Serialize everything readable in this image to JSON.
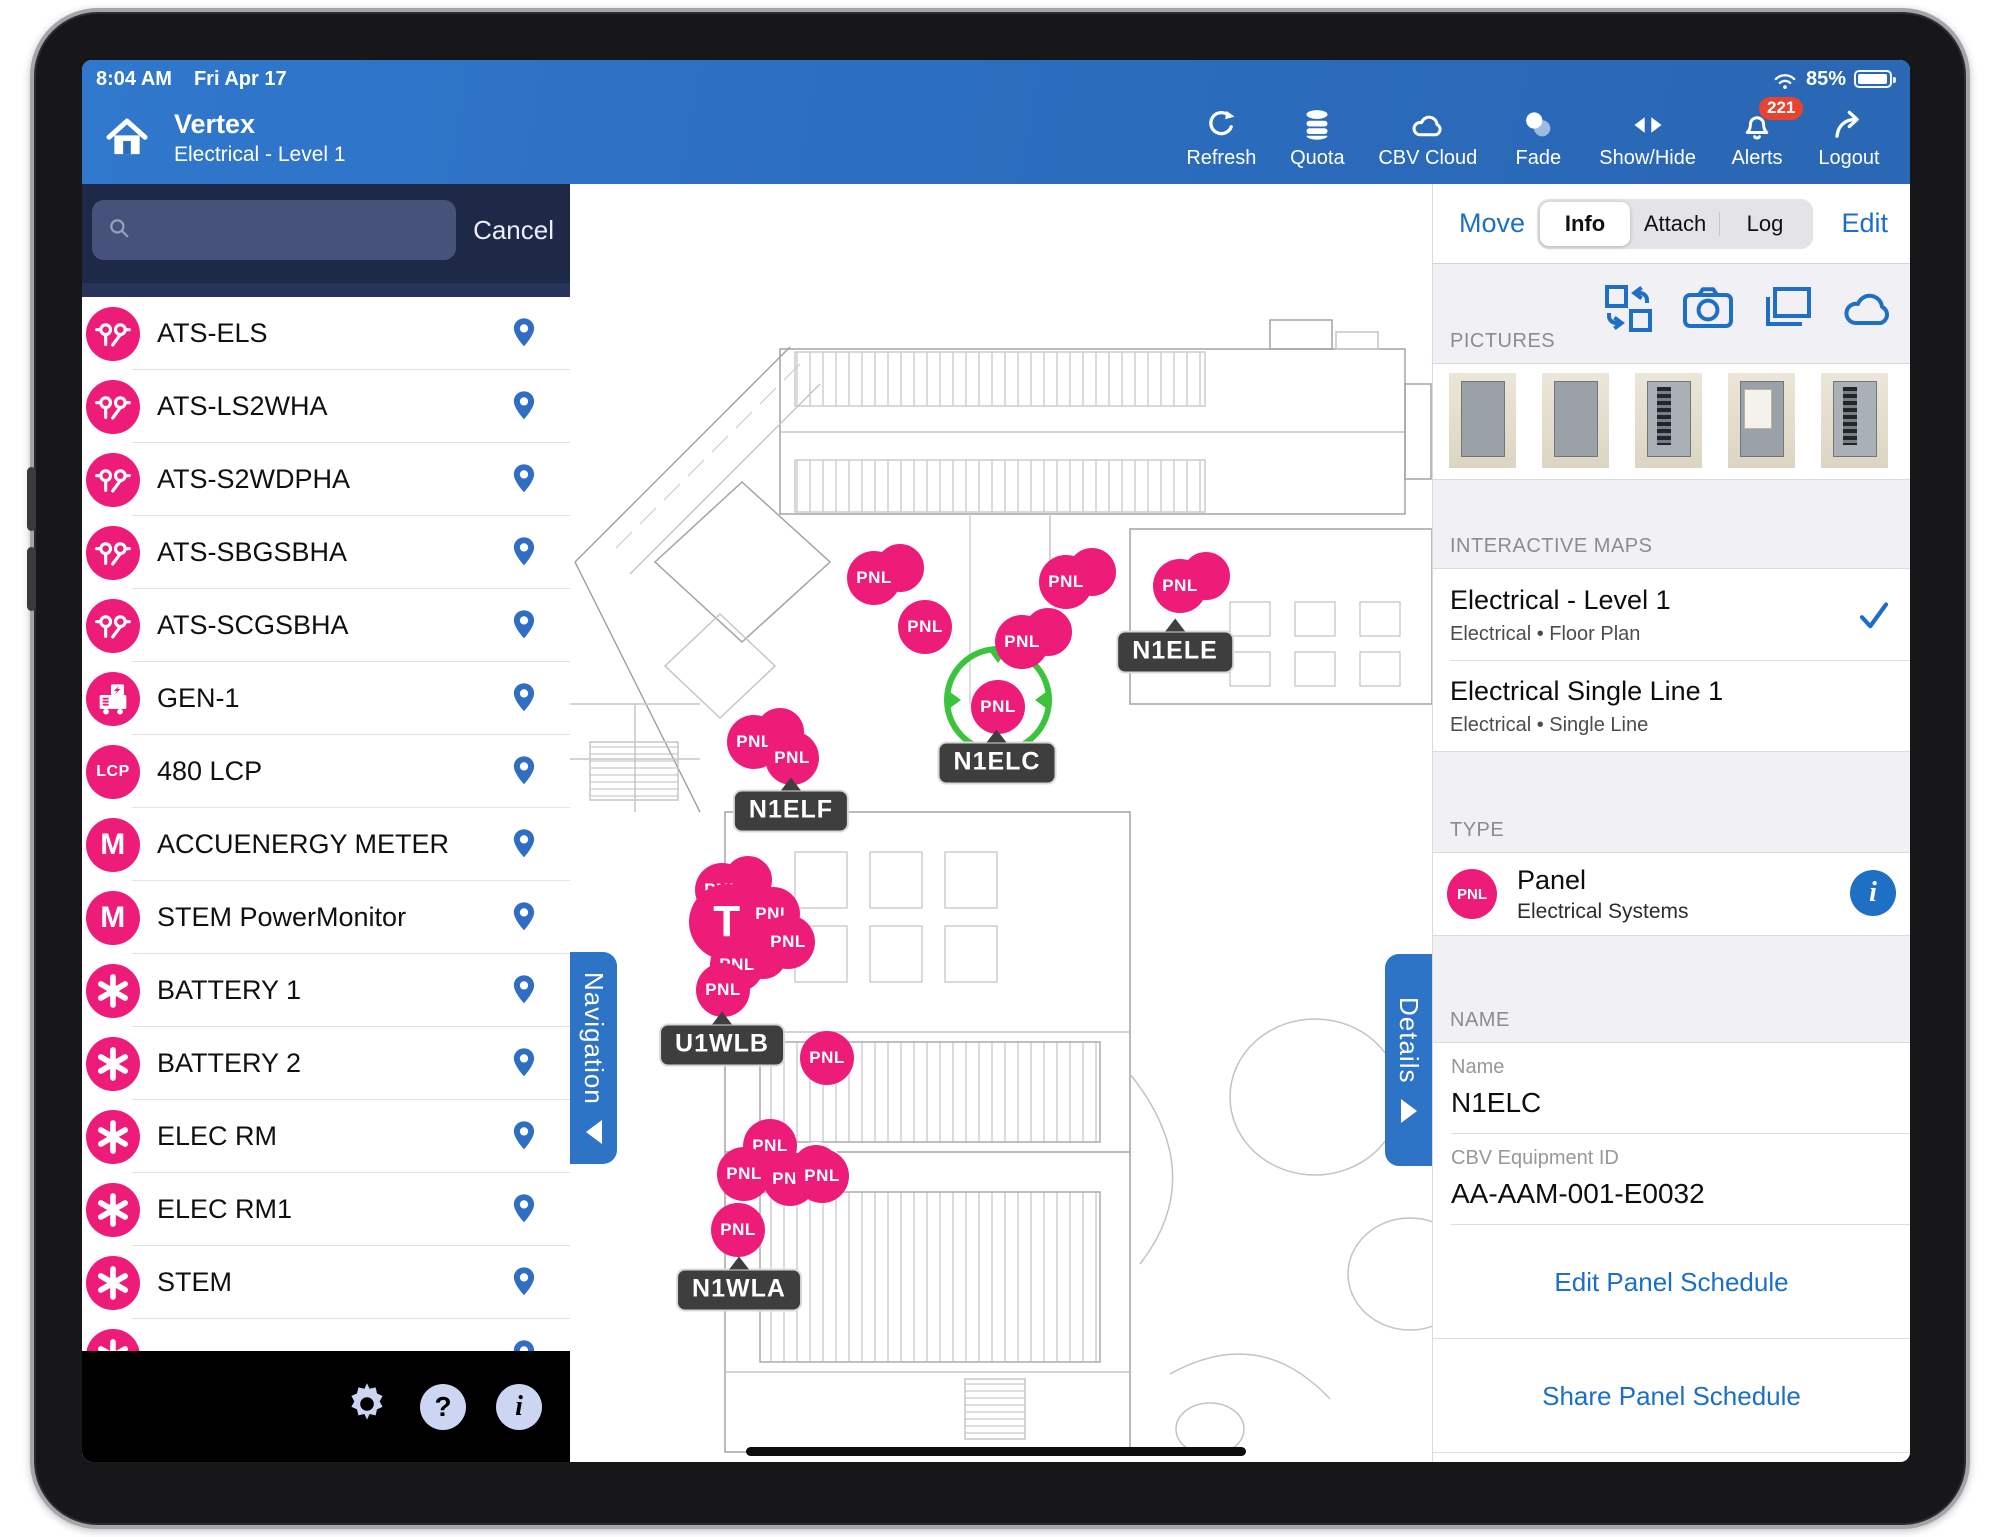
{
  "colors": {
    "brand_blue": "#2b6cbd",
    "sidebar_dark": "#1d2947",
    "marker_pink": "#EC1C78",
    "link_blue": "#1c6fc9",
    "selection_green": "#3cc33c",
    "badge_red": "#e8432e"
  },
  "status": {
    "time": "8:04 AM",
    "date": "Fri Apr 17",
    "battery": "85%"
  },
  "header": {
    "title": "Vertex",
    "subtitle": "Electrical - Level 1",
    "actions": [
      {
        "name": "refresh-button",
        "icon": "refresh",
        "label": "Refresh"
      },
      {
        "name": "quota-button",
        "icon": "database",
        "label": "Quota"
      },
      {
        "name": "cbv-cloud-button",
        "icon": "cloud",
        "label": "CBV Cloud"
      },
      {
        "name": "fade-button",
        "icon": "fade",
        "label": "Fade"
      },
      {
        "name": "show-hide-button",
        "icon": "showhide",
        "label": "Show/Hide"
      },
      {
        "name": "alerts-button",
        "icon": "bell",
        "label": "Alerts",
        "badge": "221"
      },
      {
        "name": "logout-button",
        "icon": "logout",
        "label": "Logout"
      }
    ]
  },
  "sidebar": {
    "search_placeholder": "",
    "cancel_label": "Cancel",
    "items": [
      {
        "icon": "ats",
        "label": "ATS-ELS"
      },
      {
        "icon": "ats",
        "label": "ATS-LS2WHA"
      },
      {
        "icon": "ats",
        "label": "ATS-S2WDPHA"
      },
      {
        "icon": "ats",
        "label": "ATS-SBGSBHA"
      },
      {
        "icon": "ats",
        "label": "ATS-SCGSBHA"
      },
      {
        "icon": "gen",
        "label": "GEN-1"
      },
      {
        "icon": "lcp",
        "label": "480 LCP"
      },
      {
        "icon": "meter",
        "label": "ACCUENERGY METER"
      },
      {
        "icon": "meter",
        "label": "STEM PowerMonitor"
      },
      {
        "icon": "asterisk",
        "label": "BATTERY 1"
      },
      {
        "icon": "asterisk",
        "label": "BATTERY 2"
      },
      {
        "icon": "asterisk",
        "label": "ELEC RM"
      },
      {
        "icon": "asterisk",
        "label": "ELEC RM1"
      },
      {
        "icon": "asterisk",
        "label": "STEM"
      },
      {
        "icon": "asterisk",
        "label": ""
      }
    ]
  },
  "map": {
    "nav_tab": "Navigation",
    "details_tab": "Details",
    "selection": {
      "x": 428,
      "y": 516
    },
    "markers": [
      {
        "label": "PNL",
        "x": 304,
        "y": 394,
        "echo": true
      },
      {
        "label": "PNL",
        "x": 496,
        "y": 398,
        "echo": true
      },
      {
        "label": "PNL",
        "x": 355,
        "y": 443
      },
      {
        "label": "PNL",
        "x": 452,
        "y": 458,
        "echo": true
      },
      {
        "label": "PNL",
        "x": 610,
        "y": 402,
        "echo": true
      },
      {
        "label": "PNL",
        "x": 184,
        "y": 558,
        "echo": true
      },
      {
        "label": "PNL",
        "x": 222,
        "y": 574
      },
      {
        "label": "PNL",
        "x": 152,
        "y": 706,
        "echo": true
      },
      {
        "label": "T",
        "x": 157,
        "y": 738,
        "big": true
      },
      {
        "label": "PNL",
        "x": 203,
        "y": 730
      },
      {
        "label": "PNL",
        "x": 218,
        "y": 758
      },
      {
        "label": "PNL",
        "x": 167,
        "y": 781,
        "echo": true
      },
      {
        "label": "PNL",
        "x": 153,
        "y": 806
      },
      {
        "label": "PNL",
        "x": 257,
        "y": 874
      },
      {
        "label": "PNL",
        "x": 200,
        "y": 962
      },
      {
        "label": "PNL",
        "x": 174,
        "y": 990
      },
      {
        "label": "PNL",
        "x": 220,
        "y": 995,
        "echo": true
      },
      {
        "label": "PNL",
        "x": 252,
        "y": 992
      },
      {
        "label": "PNL",
        "x": 168,
        "y": 1046
      },
      {
        "label": "PNL",
        "x": 428,
        "y": 523
      }
    ],
    "labels": [
      {
        "text": "N1ELE",
        "x": 605,
        "y": 468
      },
      {
        "text": "N1ELC",
        "x": 427,
        "y": 579
      },
      {
        "text": "N1ELF",
        "x": 221,
        "y": 627
      },
      {
        "text": "U1WLB",
        "x": 152,
        "y": 861
      },
      {
        "text": "N1WLA",
        "x": 169,
        "y": 1106
      }
    ]
  },
  "details": {
    "move_label": "Move",
    "edit_label": "Edit",
    "tabs": [
      {
        "label": "Info",
        "selected": true
      },
      {
        "label": "Attach",
        "selected": false
      },
      {
        "label": "Log",
        "selected": false
      }
    ],
    "pictures": {
      "section": "PICTURES",
      "thumbnails": [
        {
          "variant": "panel-closed"
        },
        {
          "variant": "panel-closed"
        },
        {
          "variant": "panel-open"
        },
        {
          "variant": "panel-label"
        },
        {
          "variant": "panel-open"
        }
      ]
    },
    "maps": {
      "section": "INTERACTIVE MAPS",
      "rows": [
        {
          "title": "Electrical - Level 1",
          "subtitle": "Electrical • Floor Plan",
          "checked": true
        },
        {
          "title": "Electrical Single Line 1",
          "subtitle": "Electrical • Single Line",
          "checked": false
        }
      ]
    },
    "type": {
      "section": "TYPE",
      "badge": "PNL",
      "title": "Panel",
      "subtitle": "Electrical Systems"
    },
    "name": {
      "section": "NAME",
      "fields": [
        {
          "label": "Name",
          "value": "N1ELC"
        },
        {
          "label": "CBV Equipment ID",
          "value": "AA-AAM-001-E0032"
        }
      ]
    },
    "links": [
      "Edit Panel Schedule",
      "Share Panel Schedule"
    ]
  }
}
